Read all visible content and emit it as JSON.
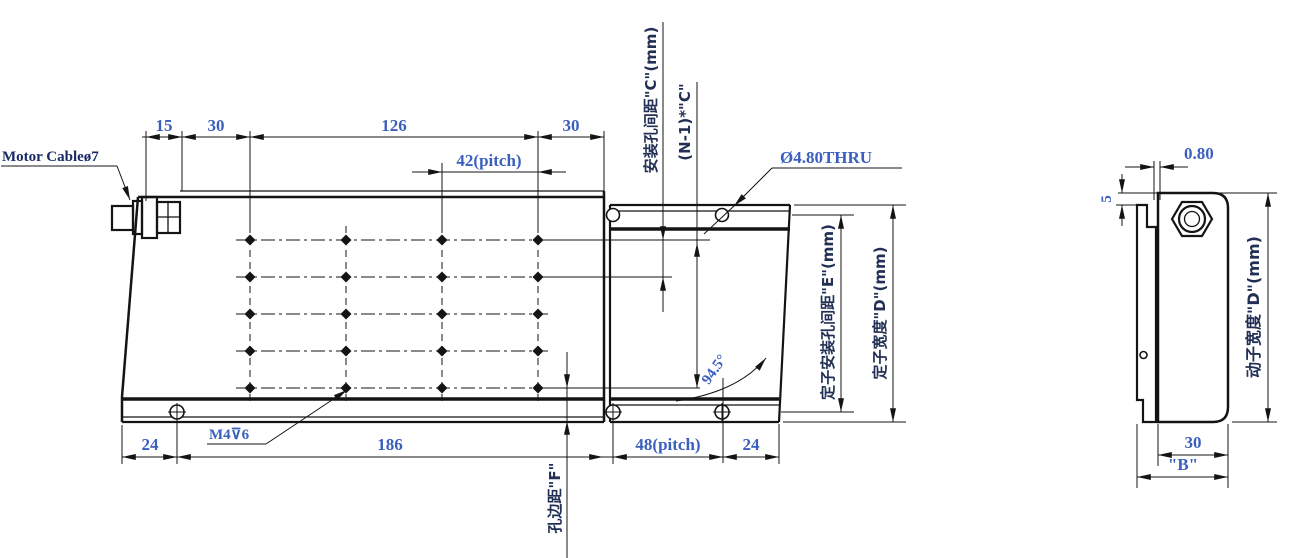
{
  "colors": {
    "line": "#141414",
    "dimension_text": "#3a5fbe",
    "label_text": "#223055",
    "callout_text": "#1a2a66"
  },
  "main_view": {
    "callouts": {
      "motor_cable": "Motor Cableø7",
      "thread_hole": "M4⊽6",
      "thru_hole": "Ø4.80THRU",
      "angle": "94.5°"
    },
    "dims_top": {
      "d15": "15",
      "d30_left": "30",
      "d126": "126",
      "d30_right": "30",
      "pitch42": "42(pitch)"
    },
    "dims_bottom": {
      "d24_left": "24",
      "d186": "186",
      "pitch48": "48(pitch)",
      "d24_right": "24"
    },
    "dims_vertical": {
      "mount_hole_spacing_c": "安装孔间距\"C\"(mm)",
      "n_minus_1_times_c": "(N-1)*\"C\"",
      "stator_mount_hole_spacing_e": "定子安装孔间距\"E\"(mm)",
      "stator_width_d": "定子宽度\"D\"(mm)",
      "hole_edge_distance_f": "孔边距\"F\""
    }
  },
  "side_view": {
    "dims": {
      "d0_80": "0.80",
      "d5": "5",
      "d30": "30",
      "d_b": "\"B\"",
      "mover_width_d": "动子宽度\"D\"(mm)"
    }
  }
}
